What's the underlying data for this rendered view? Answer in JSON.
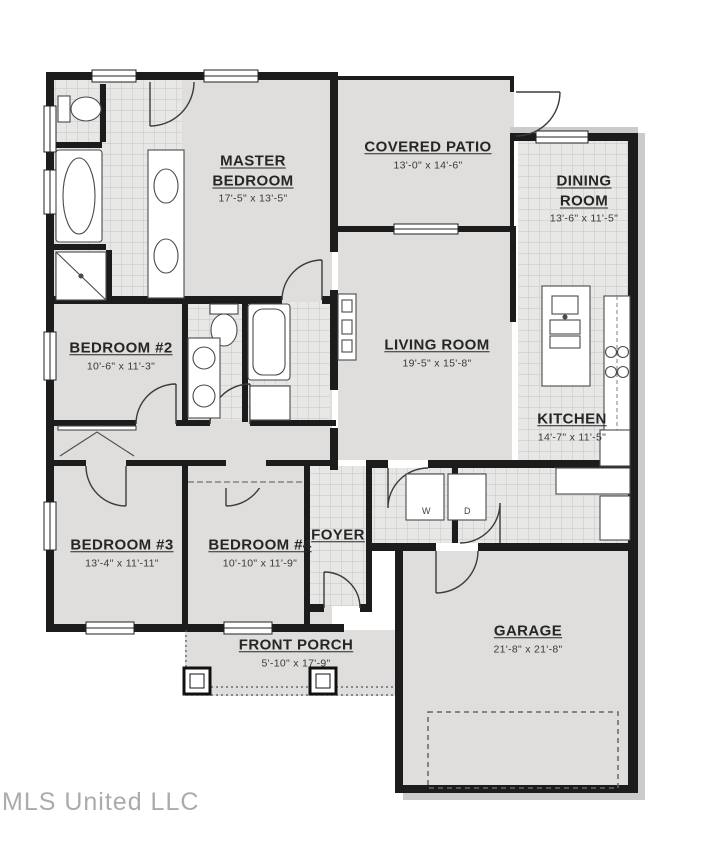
{
  "title": "Residential floor plan",
  "watermark": "MLS United LLC",
  "colors": {
    "wall": "#1c1c1c",
    "floor": "#dfdedc",
    "tile_floor": "#e7e7e5",
    "tile_line": "#c6c6c4",
    "label_text": "#262626",
    "watermark": "#ababa9"
  },
  "rooms": [
    {
      "id": "master-bedroom",
      "name": "MASTER BEDROOM",
      "dims": "17'-5\" x 13'-5\""
    },
    {
      "id": "covered-patio",
      "name": "COVERED PATIO",
      "dims": "13'-0\" x 14'-6\""
    },
    {
      "id": "dining-room",
      "name": "DINING ROOM",
      "dims": "13'-6\" x 11'-5\""
    },
    {
      "id": "living-room",
      "name": "LIVING ROOM",
      "dims": "19'-5\" x 15'-8\""
    },
    {
      "id": "kitchen",
      "name": "KITCHEN",
      "dims": "14'-7\" x 11'-5\""
    },
    {
      "id": "bedroom-2",
      "name": "BEDROOM #2",
      "dims": "10'-6\" x 11'-3\""
    },
    {
      "id": "bedroom-3",
      "name": "BEDROOM #3",
      "dims": "13'-4\" x 11'-11\""
    },
    {
      "id": "bedroom-4",
      "name": "BEDROOM #4",
      "dims": "10'-10\" x 11'-9\""
    },
    {
      "id": "foyer",
      "name": "FOYER",
      "dims": ""
    },
    {
      "id": "front-porch",
      "name": "FRONT PORCH",
      "dims": "5'-10\" x 17'-9\""
    },
    {
      "id": "garage",
      "name": "GARAGE",
      "dims": "21'-8\" x 21'-8\""
    }
  ],
  "laundry": {
    "washer_label": "W",
    "dryer_label": "D"
  }
}
